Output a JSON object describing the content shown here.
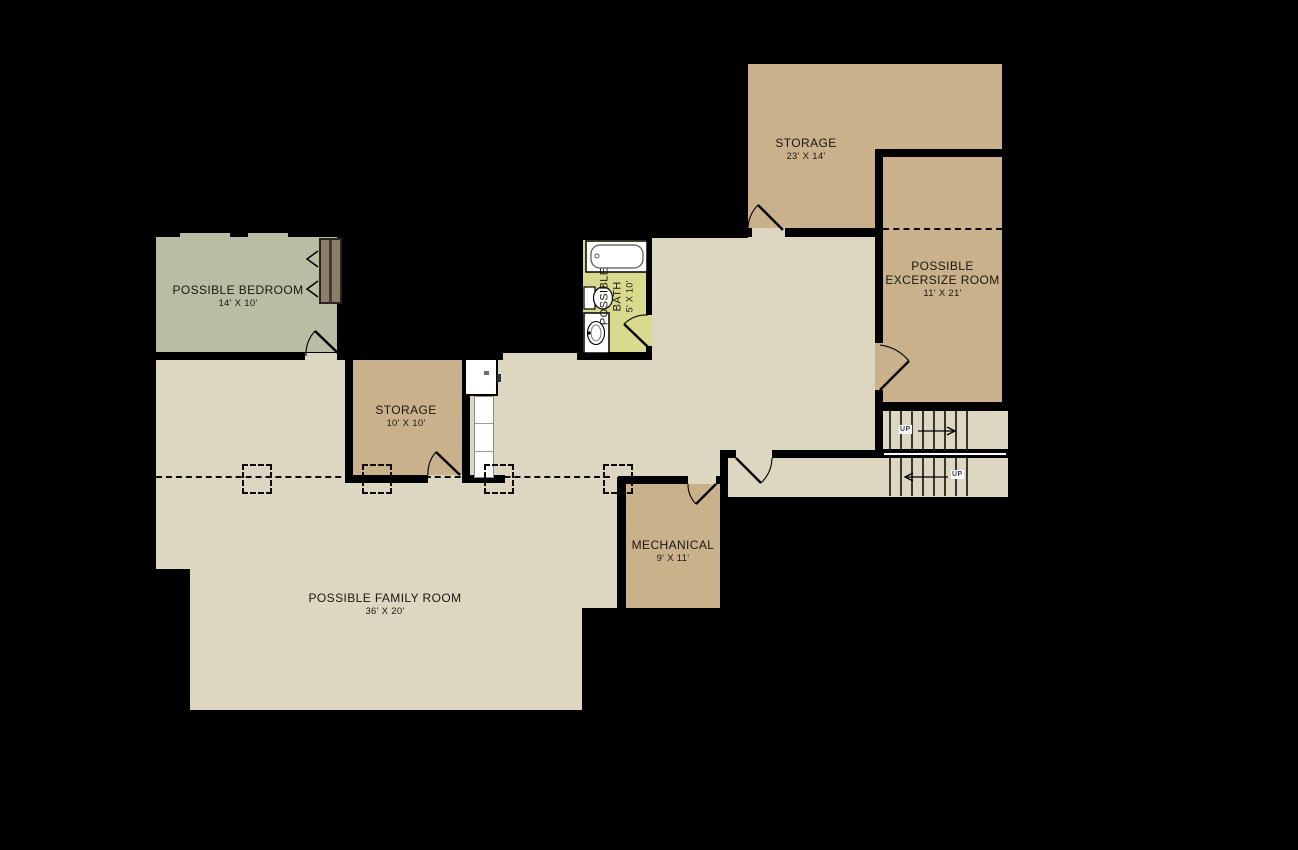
{
  "plan_type": "basement floor plan",
  "rooms": {
    "storage_large": {
      "name": "STORAGE",
      "dims": "23' X 14'"
    },
    "exercise": {
      "name": "POSSIBLE EXCERSIZE ROOM",
      "dims": "11' X 21'"
    },
    "bedroom": {
      "name": "POSSIBLE BEDROOM",
      "dims": "14' X 10'"
    },
    "storage_small": {
      "name": "STORAGE",
      "dims": "10' X 10'"
    },
    "bath": {
      "name": "POSSIBLE BATH",
      "dims": "5' X 10'"
    },
    "mechanical": {
      "name": "MECHANICAL",
      "dims": "9' X 11'"
    },
    "family": {
      "name": "POSSIBLE FAMILY ROOM",
      "dims": "36' X 20'"
    }
  },
  "stairs": {
    "up_upper": "UP",
    "up_lower": "UP"
  },
  "colors": {
    "background": "#000000",
    "floor": "#ddd7c2",
    "room_tan": "#c9b18c",
    "bedroom_green": "#b8bda3",
    "bath_yellow": "#d8db8e",
    "wall": "#000000",
    "closet_door_brown": "#8d7d6b"
  }
}
